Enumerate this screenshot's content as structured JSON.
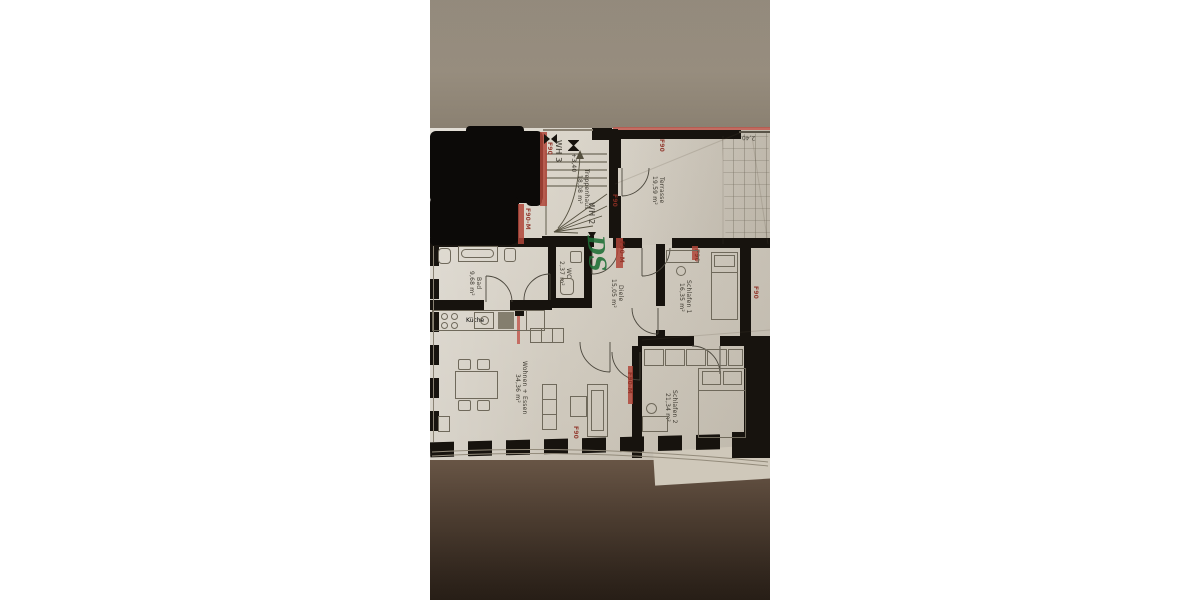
{
  "photo": {
    "plan": {
      "units": {
        "wh2_label": "WH 2",
        "wh3_label": "WH 3"
      },
      "level_marker": "+3,40",
      "dimension_top_right": "2,40",
      "handwritten_initials": "DS",
      "rooms": {
        "treppenhaus": {
          "name": "Treppenhaus",
          "area": "18,08 m²"
        },
        "terrasse": {
          "name": "Terrasse",
          "area": "19,59 m²"
        },
        "bad": {
          "name": "Bad",
          "area": "9,68 m²"
        },
        "wc": {
          "name": "WC",
          "area": "2,37 m²"
        },
        "diele": {
          "name": "Diele",
          "area": "15,05 m²"
        },
        "schlafen1": {
          "name": "Schlafen 1",
          "area": "16,35 m²"
        },
        "kueche": {
          "name": "Küche"
        },
        "wohnen_essen": {
          "name": "Wohnen + Essen",
          "area": "34,36 m²"
        },
        "schlafen2": {
          "name": "Schlafen 2",
          "area": "21,34 m²"
        }
      },
      "fire_ratings": {
        "f90": "F90",
        "f90m": "F90-M"
      }
    },
    "colors": {
      "background": "#ffffff",
      "surface_top": "#968c7d",
      "surface_bottom": "#30261d",
      "paper": "#d7d1c5",
      "wall": "#17130e",
      "fire_red": "#b0463a",
      "marker_green": "#1e6f36",
      "redaction": "#0c0a08"
    }
  }
}
